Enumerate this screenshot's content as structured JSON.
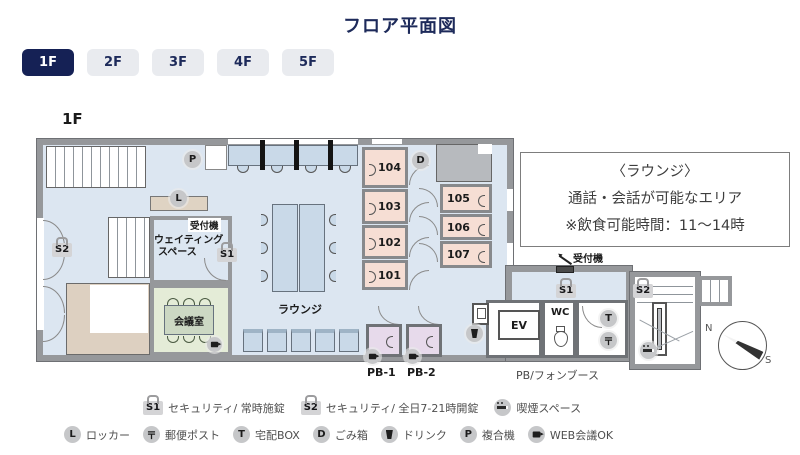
{
  "header": {
    "title": "フロア平面図"
  },
  "tabs": [
    {
      "label": "1F",
      "active": true
    },
    {
      "label": "2F",
      "active": false
    },
    {
      "label": "3F",
      "active": false
    },
    {
      "label": "4F",
      "active": false
    },
    {
      "label": "5F",
      "active": false
    }
  ],
  "plan": {
    "floor_label": "1F",
    "labels": {
      "reception": "受付機",
      "waiting_1": "ウェイティング",
      "waiting_2": "スペース",
      "meeting_room": "会議室",
      "lounge": "ラウンジ",
      "ev": "EV",
      "wc": "WC",
      "pb1": "PB-1",
      "pb2": "PB-2",
      "phone_booth": "PB/フォンブース",
      "compass_n": "N",
      "compass_s": "S"
    },
    "badges": {
      "s1": "S1",
      "s2": "S2"
    },
    "icons": {
      "printer": "P",
      "locker": "L",
      "trash": "D",
      "delivery": "T",
      "post": "〒"
    },
    "rooms": {
      "r101": "101",
      "r102": "102",
      "r103": "103",
      "r104": "104",
      "r105": "105",
      "r106": "106",
      "r107": "107"
    }
  },
  "info_box": {
    "line1": "〈ラウンジ〉",
    "line2": "通話・会話が可能なエリア",
    "line3": "※飲食可能時間：11〜14時"
  },
  "legend": {
    "row1": [
      {
        "badge": "S1",
        "label": "セキュリティ/ 常時施錠"
      },
      {
        "badge": "S2",
        "label": "セキュリティ/ 全日7-21時開錠"
      },
      {
        "icon": "smoking",
        "label": "喫煙スペース"
      }
    ],
    "row2": [
      {
        "icon": "L",
        "label": "ロッカー"
      },
      {
        "icon": "〒",
        "label": "郵便ポスト"
      },
      {
        "icon": "T",
        "label": "宅配BOX"
      },
      {
        "icon": "D",
        "label": "ごみ箱"
      },
      {
        "icon": "drink",
        "label": "ドリンク"
      },
      {
        "icon": "P",
        "label": "複合機"
      },
      {
        "icon": "camera",
        "label": "WEB会議OK"
      }
    ]
  },
  "colors": {
    "navy": "#152155",
    "tab_inactive": "#e9ebef",
    "floor_blue": "#dce6f1",
    "wall_gray": "#96989b",
    "room_pink": "#f6ded4",
    "meeting_green": "#e4ecd7",
    "booth_purple": "#e7daeb",
    "entrance_tan": "#ddd0c1",
    "icon_gray": "#c6c7c9"
  }
}
